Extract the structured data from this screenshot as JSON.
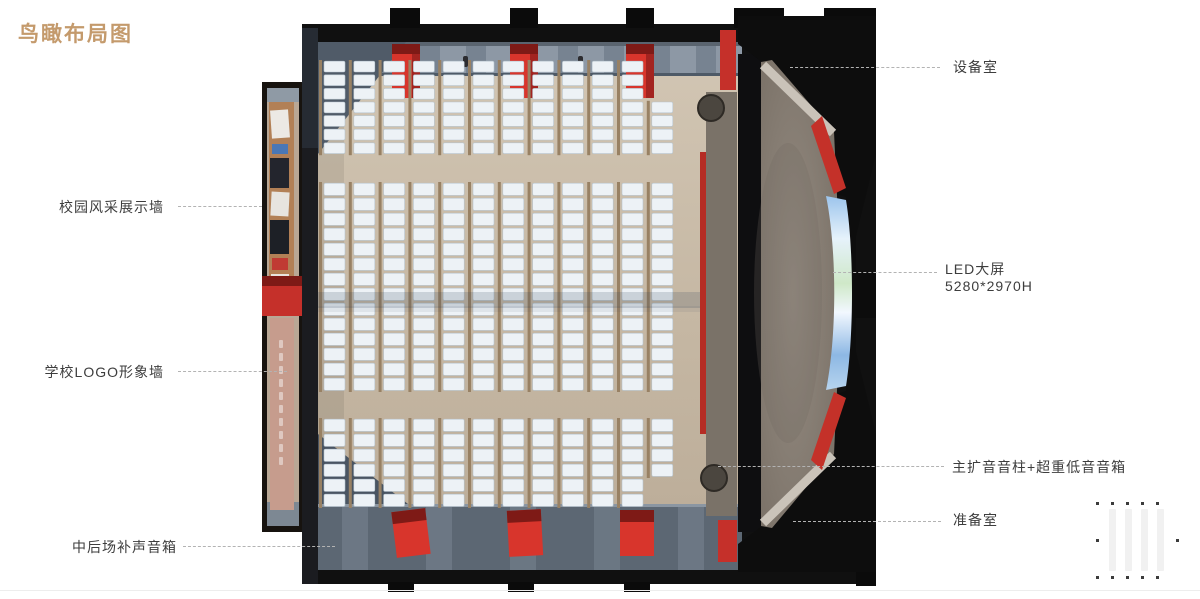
{
  "title": {
    "text": "鸟瞰布局图"
  },
  "callouts": {
    "campus_wall": "校园风采展示墙",
    "logo_wall": "学校LOGO形象墙",
    "rear_speakers": "中后场补声音箱",
    "equipment_room": "设备室",
    "led_screen_line1": "LED大屏",
    "led_screen_line2": "5280*2970H",
    "main_speakers": "主扩音音柱+超重低音音箱",
    "prep_room": "准备室"
  },
  "colors": {
    "title": "#c49a6c",
    "label": "#3d3d3d",
    "leader": "#b3b3b3",
    "red": "#c5302a",
    "red_bright": "#d8352c",
    "red_dark": "#7e1a16",
    "black": "#101010",
    "floor": "#c6b7a3",
    "walkway_top": "#8d98a5",
    "walkway_bottom": "#5c6773",
    "seat": "#edf2f6",
    "seat_stroke": "#b7c4cd",
    "armrest": "#988164",
    "stage": "#857b70",
    "apron": "#8f8478",
    "rim": "#cac3b9",
    "wood_wall": "#b28056",
    "pink_wall": "#c69c8d",
    "led_blue": "#8db8e4"
  },
  "diagram": {
    "subject": "礼堂鸟瞰布局渲染图",
    "seating": {
      "columns": 12,
      "col_start": 66,
      "col_spacing": 29.8,
      "seat_width": 21,
      "blocks": [
        {
          "y": 56,
          "rows": 7,
          "row_h": 13.6
        },
        {
          "y": 178,
          "rows": 14,
          "row_h": 15
        },
        {
          "y": 414,
          "rows": 6,
          "row_h": 15
        }
      ],
      "exceptions": [
        {
          "block": 0,
          "col": 11,
          "skip_first": 3
        },
        {
          "block": 2,
          "col": 11,
          "keep_first": 4
        }
      ]
    }
  }
}
